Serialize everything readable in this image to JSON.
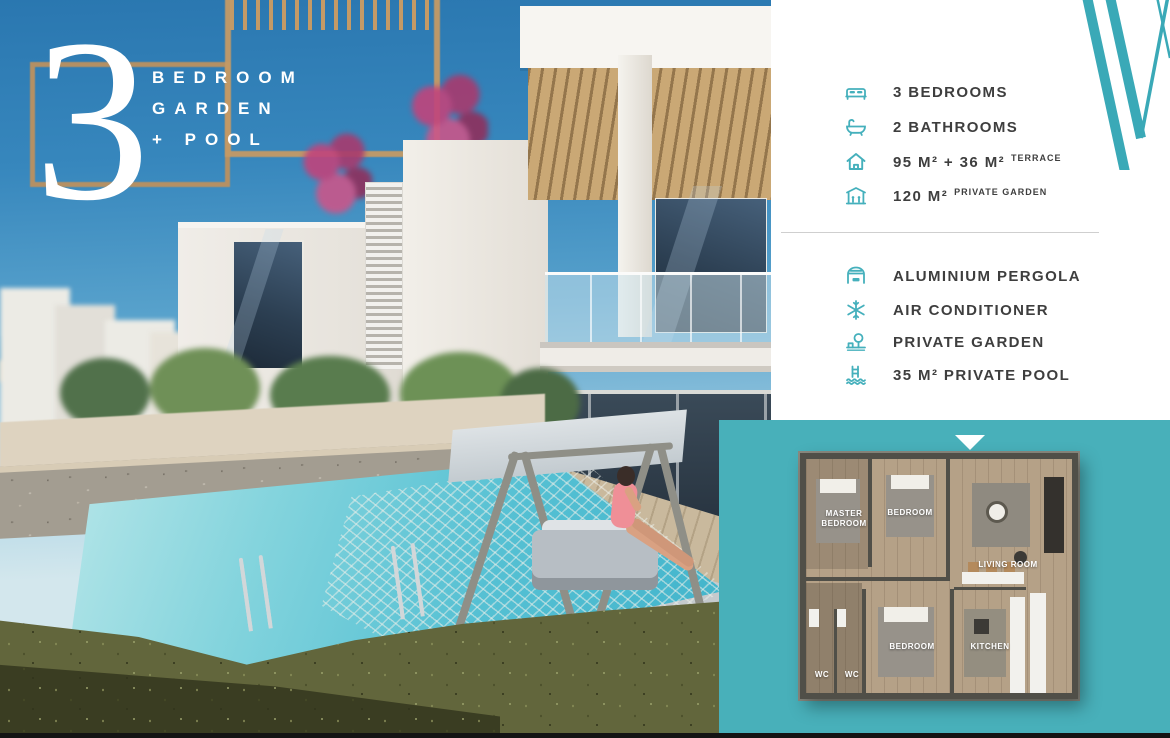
{
  "hero": {
    "number": "3",
    "lines": [
      "BEDROOM",
      "GARDEN",
      "+ POOL"
    ]
  },
  "specs": [
    {
      "icon": "bed-icon",
      "text": "3 BEDROOMS",
      "suffix": ""
    },
    {
      "icon": "bathtub-icon",
      "text": "2 BATHROOMS",
      "suffix": ""
    },
    {
      "icon": "house-icon",
      "text": "95 M² + 36 M²",
      "suffix": "TERRACE"
    },
    {
      "icon": "pergola-garden-icon",
      "text": "120 M²",
      "suffix": "PRIVATE GARDEN"
    }
  ],
  "features": [
    {
      "icon": "aluminium-pergola-icon",
      "text": "ALUMINIUM PERGOLA"
    },
    {
      "icon": "air-conditioner-icon",
      "text": "AIR CONDITIONER"
    },
    {
      "icon": "private-garden-icon",
      "text": "PRIVATE GARDEN"
    },
    {
      "icon": "private-pool-icon",
      "text": "35 M² PRIVATE POOL"
    }
  ],
  "floor_plan": {
    "rooms": [
      {
        "name": "MASTER BEDROOM"
      },
      {
        "name": "BEDROOM"
      },
      {
        "name": "LIVING ROOM"
      },
      {
        "name": "BEDROOM"
      },
      {
        "name": "KITCHEN"
      },
      {
        "name": "WC"
      },
      {
        "name": "WC"
      }
    ]
  },
  "colors": {
    "accent_teal": "#45b0bc",
    "panel_teal": "#48b0ba",
    "text_dark": "#3e3e3e",
    "headline_white": "#ffffff"
  }
}
